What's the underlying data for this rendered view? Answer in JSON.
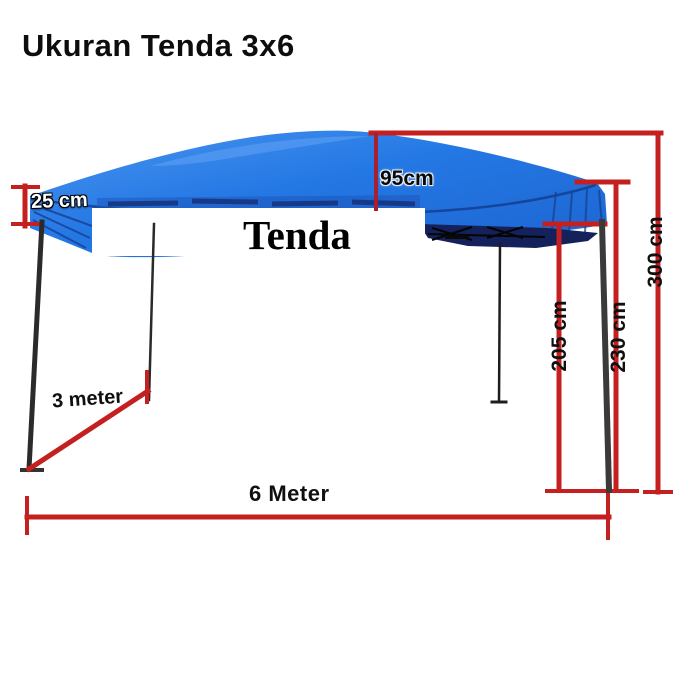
{
  "title": "Ukuran Tenda 3x6",
  "tent": {
    "label": "Tenda",
    "canopy_color": "#2478e4",
    "underside_color": "#14215a",
    "frame_color": "#2d2d2d",
    "dimension_color": "#c42020"
  },
  "dimensions": {
    "valance_height": "25 cm",
    "roof_peak_height": "95cm",
    "wall_clearance": "205 cm",
    "leg_height": "230 cm",
    "total_height": "300 cm",
    "depth": "3 meter",
    "width": "6 Meter"
  }
}
